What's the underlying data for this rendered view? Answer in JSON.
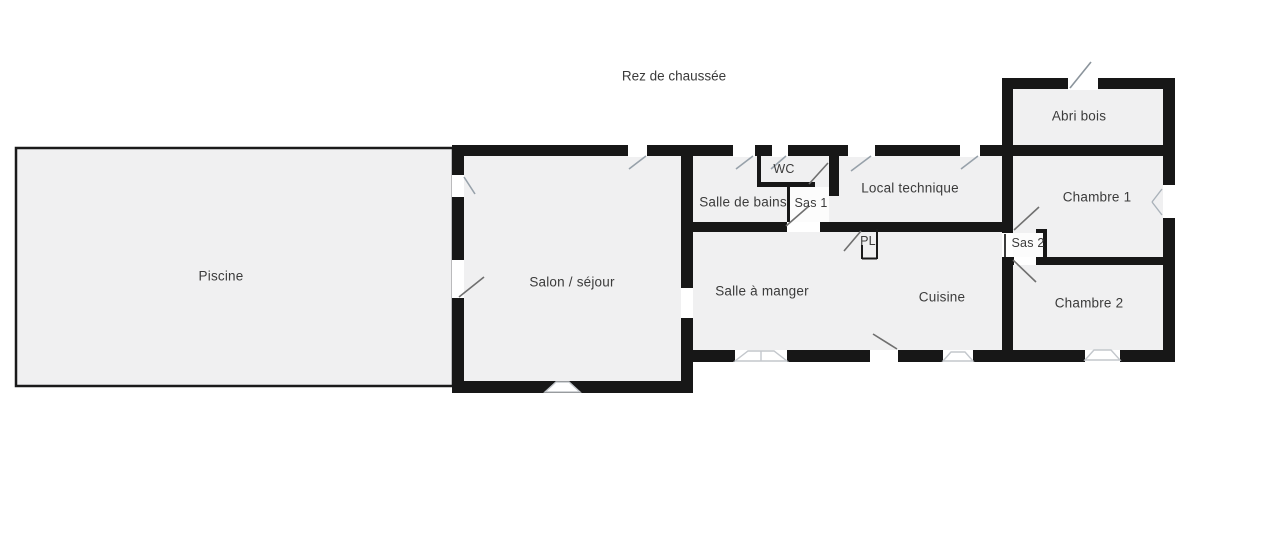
{
  "title": "Rez de chaussée",
  "rooms": [
    {
      "id": "piscine",
      "label": "Piscine"
    },
    {
      "id": "salon-sejour",
      "label": "Salon / séjour"
    },
    {
      "id": "salle-de-bains",
      "label": "Salle de bains"
    },
    {
      "id": "wc",
      "label": "WC"
    },
    {
      "id": "sas-1",
      "label": "Sas 1"
    },
    {
      "id": "local-technique",
      "label": "Local technique"
    },
    {
      "id": "pl",
      "label": "PL"
    },
    {
      "id": "salle-a-manger",
      "label": "Salle à manger"
    },
    {
      "id": "cuisine",
      "label": "Cuisine"
    },
    {
      "id": "abri-bois",
      "label": "Abri bois"
    },
    {
      "id": "chambre-1",
      "label": "Chambre 1"
    },
    {
      "id": "sas-2",
      "label": "Sas 2"
    },
    {
      "id": "chambre-2",
      "label": "Chambre 2"
    }
  ],
  "colors": {
    "wall": "#171717",
    "room_fill": "#f0f0f1",
    "vestibule_fill": "#fcfcfc",
    "window_symbol": "#97a1aa",
    "door_symbol": "#6f6f6f",
    "text": "#3b3b3b"
  }
}
